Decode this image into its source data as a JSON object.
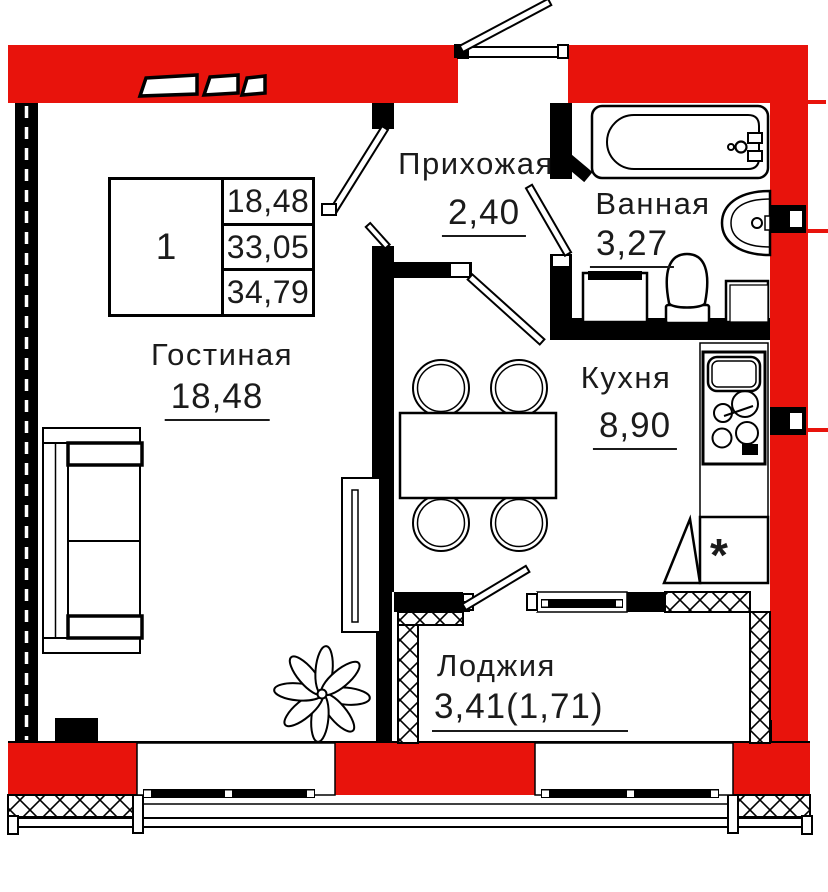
{
  "colors": {
    "wall_red": "#e8130c",
    "wall_black": "#000000"
  },
  "unit_table": {
    "unit_number": "1",
    "living_area": "18,48",
    "apartment_area": "33,05",
    "total_area": "34,79"
  },
  "rooms": {
    "hallway": {
      "name": "Прихожая",
      "area": "2,40"
    },
    "bathroom": {
      "name": "Ванная",
      "area": "3,27"
    },
    "living": {
      "name": "Гостиная",
      "area": "18,48"
    },
    "kitchen": {
      "name": "Кухня",
      "area": "8,90"
    },
    "loggia": {
      "name": "Лоджия",
      "area": "3,41(1,71)"
    }
  },
  "marks": {
    "fridge": "*"
  }
}
